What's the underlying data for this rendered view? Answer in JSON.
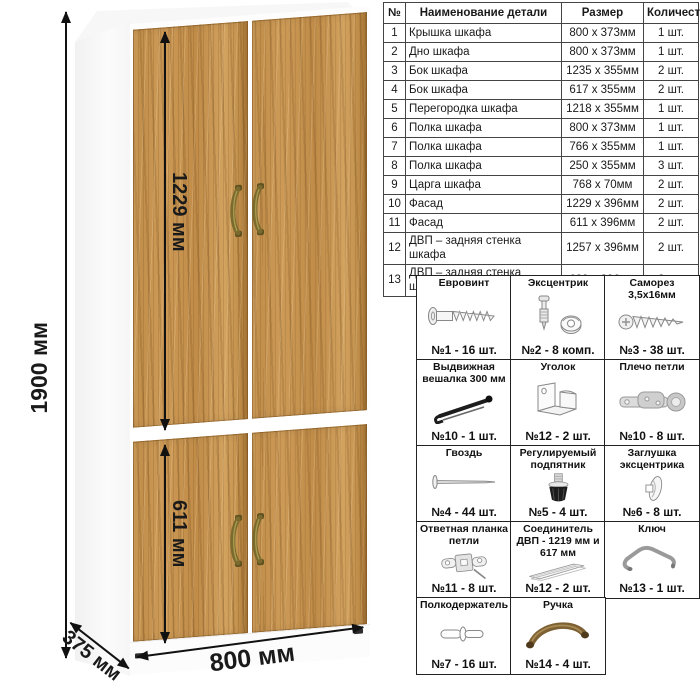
{
  "diagram": {
    "dimensions": {
      "total_height": "1900 мм",
      "upper_door_height": "1229 мм",
      "lower_door_height": "611 мм",
      "width": "800 мм",
      "depth": "375 мм"
    },
    "colors": {
      "wood": "#c6924d",
      "carcass": "#ffffff",
      "handle_brass": "#7a6a2e",
      "dimension_line": "#111111"
    }
  },
  "parts_table": {
    "headers": {
      "num": "№",
      "name": "Наименование детали",
      "size": "Размер",
      "qty": "Количество"
    },
    "rows": [
      {
        "num": "1",
        "name": "Крышка шкафа",
        "size": "800 х 373мм",
        "qty": "1 шт."
      },
      {
        "num": "2",
        "name": "Дно шкафа",
        "size": "800 х 373мм",
        "qty": "1 шт."
      },
      {
        "num": "3",
        "name": "Бок шкафа",
        "size": "1235 х 355мм",
        "qty": "2 шт."
      },
      {
        "num": "4",
        "name": "Бок шкафа",
        "size": "617 х 355мм",
        "qty": "2 шт."
      },
      {
        "num": "5",
        "name": "Перегородка шкафа",
        "size": "1218 х 355мм",
        "qty": "1 шт."
      },
      {
        "num": "6",
        "name": "Полка шкафа",
        "size": "800 х 373мм",
        "qty": "1 шт."
      },
      {
        "num": "7",
        "name": "Полка шкафа",
        "size": "766 х 355мм",
        "qty": "1 шт."
      },
      {
        "num": "8",
        "name": "Полка шкафа",
        "size": "250 х 355мм",
        "qty": "3 шт."
      },
      {
        "num": "9",
        "name": "Царга шкафа",
        "size": "768 х 70мм",
        "qty": "2 шт."
      },
      {
        "num": "10",
        "name": "Фасад",
        "size": "1229 х 396мм",
        "qty": "2 шт."
      },
      {
        "num": "11",
        "name": "Фасад",
        "size": "611 х 396мм",
        "qty": "2 шт."
      },
      {
        "num": "12",
        "name": "ДВП – задняя стенка шкафа",
        "size": "1257 х 396мм",
        "qty": "2 шт."
      },
      {
        "num": "13",
        "name": "ДВП – задняя стенка шкафа",
        "size": "639 х 396мм",
        "qty": "2 шт."
      }
    ]
  },
  "hardware": {
    "items": [
      {
        "title": "Евровинт",
        "count": "№1 - 16 шт."
      },
      {
        "title": "Эксцентрик",
        "count": "№2 - 8 комп."
      },
      {
        "title": "Саморез 3,5х16мм",
        "count": "№3 - 38 шт."
      },
      {
        "title": "Выдвижная вешалка 300 мм",
        "count": "№10 - 1 шт."
      },
      {
        "title": "Уголок",
        "count": "№12 - 2 шт."
      },
      {
        "title": "Плечо петли",
        "count": "№10 - 8 шт."
      },
      {
        "title": "Гвоздь",
        "count": "№4 - 44 шт."
      },
      {
        "title": "Регулируемый подпятник",
        "count": "№5 - 4 шт."
      },
      {
        "title": "Заглушка эксцентрика",
        "count": "№6 - 8 шт."
      },
      {
        "title": "Ответная планка петли",
        "count": "№11 - 8 шт."
      },
      {
        "title": "Соединитель ДВП - 1219 мм и 617 мм",
        "count": "№12 - 2 шт."
      },
      {
        "title": "Ключ",
        "count": "№13 - 1 шт."
      },
      {
        "title": "Полкодержатель",
        "count": "№7 - 16 шт."
      },
      {
        "title": "Ручка",
        "count": "№14 - 4 шт."
      }
    ]
  }
}
